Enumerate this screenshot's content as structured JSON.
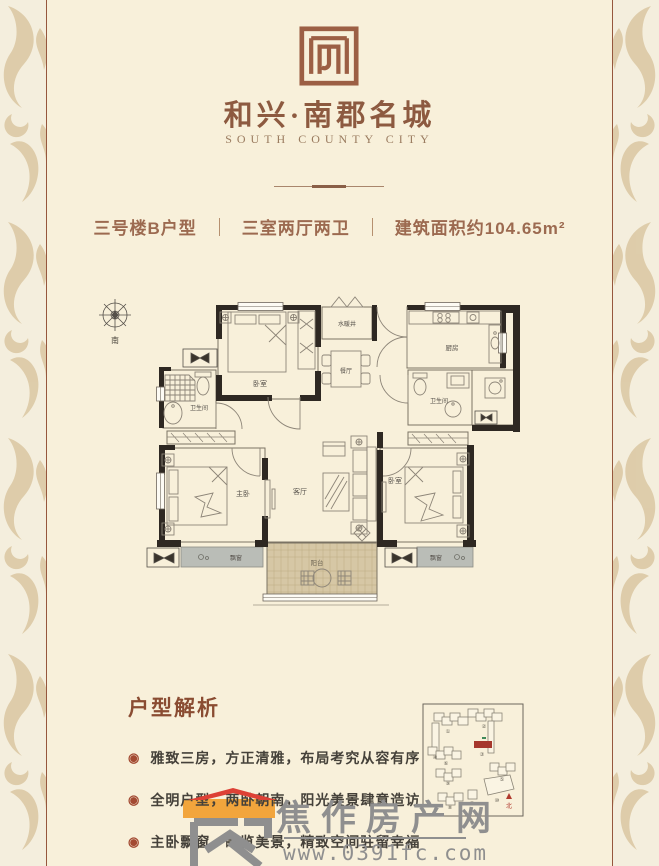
{
  "colors": {
    "background": "#f8f0da",
    "brand_brown": "#8d5a40",
    "accent_red": "#a34a32",
    "wall_black": "#2e2822",
    "watermark_gray": "#8f8f8f",
    "watermark_red": "#dd4136",
    "watermark_orange": "#f2a53c",
    "highlight_building_red": "#a6372c"
  },
  "header": {
    "title": "和兴·南郡名城",
    "subtitle": "SOUTH COUNTY CITY"
  },
  "info_bar": {
    "unit": "三号楼B户型",
    "layout": "三室两厅两卫",
    "area": "建筑面积约104.65m²"
  },
  "floor_plan": {
    "compass": "南",
    "labels": {
      "bedroom_top": "卧室",
      "water_well": "水暖井",
      "dining": "餐厅",
      "kitchen": "厨房",
      "bath_left": "卫生间",
      "bath_right": "卫生间",
      "master": "主卧",
      "living": "客厅",
      "bedroom_right": "卧室",
      "balcony": "阳台",
      "bay_left": "飘窗",
      "bay_right": "飘窗"
    }
  },
  "analysis": {
    "heading": "户型解析",
    "bullet_icon": "◉",
    "bullets": [
      "雅致三房，方正清雅，布局考究从容有序",
      "全明户型，两卧朝南，阳光美景肆意造访",
      "主卧飘窗，瞰览美景，精致空间驻留幸福"
    ]
  },
  "site_plan": {
    "north": "北",
    "building_numbers": [
      "①",
      "②",
      "③",
      "④",
      "⑤",
      "⑥",
      "⑦",
      "⑧",
      "⑨",
      "⑩"
    ]
  },
  "watermark": {
    "name": "焦作房产网",
    "url": "www.0391fc.com"
  }
}
